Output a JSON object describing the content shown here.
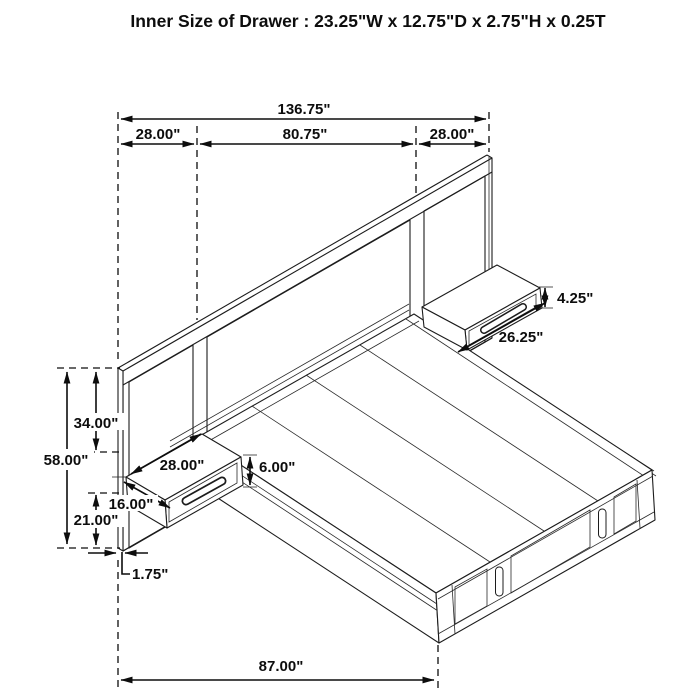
{
  "title": "Inner Size of Drawer : 23.25\"W x 12.75\"D x 2.75\"H x 0.25T",
  "diagram": {
    "type": "bed-dimension-diagram",
    "dims": {
      "total_width": "136.75\"",
      "left_section": "28.00\"",
      "center_section": "80.75\"",
      "right_section": "28.00\"",
      "right_nightstand_height": "4.25\"",
      "right_nightstand_width": "26.25\"",
      "headboard_upper_height": "34.00\"",
      "headboard_total_height": "58.00\"",
      "left_nightstand_width": "28.00\"",
      "left_nightstand_front_height": "6.00\"",
      "left_nightstand_depth": "16.00\"",
      "headboard_lower_height": "21.00\"",
      "panel_thickness": "1.75\"",
      "bed_length": "87.00\""
    }
  }
}
